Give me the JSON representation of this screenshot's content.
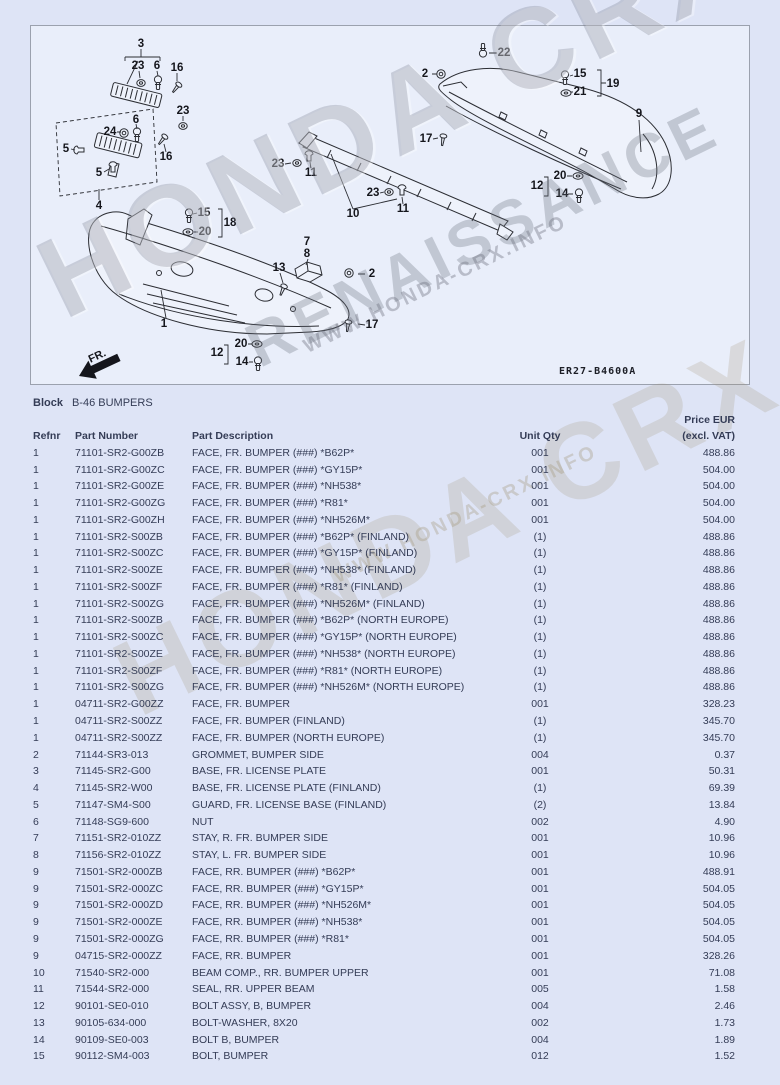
{
  "watermark": {
    "line1": "HONDA CRX",
    "line2": "RENAISSANCE",
    "line3": "WWW.HONDA-CRX.INFO"
  },
  "diagram": {
    "code": "ER27-B4600A",
    "fr_label": "FR.",
    "callouts": [
      {
        "n": "3",
        "x": 110,
        "y": 18
      },
      {
        "n": "23",
        "x": 107,
        "y": 40
      },
      {
        "n": "6",
        "x": 126,
        "y": 40
      },
      {
        "n": "16",
        "x": 146,
        "y": 42
      },
      {
        "n": "23",
        "x": 152,
        "y": 85
      },
      {
        "n": "6",
        "x": 105,
        "y": 94
      },
      {
        "n": "24",
        "x": 79,
        "y": 106
      },
      {
        "n": "16",
        "x": 135,
        "y": 131
      },
      {
        "n": "5",
        "x": 35,
        "y": 123
      },
      {
        "n": "5",
        "x": 68,
        "y": 147
      },
      {
        "n": "4",
        "x": 68,
        "y": 180
      },
      {
        "n": "22",
        "x": 473,
        "y": 27
      },
      {
        "n": "2",
        "x": 394,
        "y": 48
      },
      {
        "n": "15",
        "x": 549,
        "y": 48
      },
      {
        "n": "21",
        "x": 549,
        "y": 66
      },
      {
        "n": "19",
        "x": 582,
        "y": 58
      },
      {
        "n": "9",
        "x": 608,
        "y": 88
      },
      {
        "n": "17",
        "x": 395,
        "y": 113
      },
      {
        "n": "20",
        "x": 529,
        "y": 150
      },
      {
        "n": "12",
        "x": 506,
        "y": 160
      },
      {
        "n": "14",
        "x": 531,
        "y": 168
      },
      {
        "n": "23",
        "x": 247,
        "y": 138
      },
      {
        "n": "11",
        "x": 280,
        "y": 147
      },
      {
        "n": "23",
        "x": 342,
        "y": 167
      },
      {
        "n": "11",
        "x": 372,
        "y": 183
      },
      {
        "n": "10",
        "x": 322,
        "y": 188
      },
      {
        "n": "15",
        "x": 173,
        "y": 187
      },
      {
        "n": "20",
        "x": 174,
        "y": 206
      },
      {
        "n": "18",
        "x": 199,
        "y": 197
      },
      {
        "n": "7",
        "x": 276,
        "y": 216
      },
      {
        "n": "8",
        "x": 276,
        "y": 228
      },
      {
        "n": "13",
        "x": 248,
        "y": 242
      },
      {
        "n": "2",
        "x": 341,
        "y": 248
      },
      {
        "n": "1",
        "x": 133,
        "y": 298
      },
      {
        "n": "17",
        "x": 341,
        "y": 299
      },
      {
        "n": "20",
        "x": 210,
        "y": 318
      },
      {
        "n": "12",
        "x": 186,
        "y": 327
      },
      {
        "n": "14",
        "x": 211,
        "y": 336
      }
    ]
  },
  "block": {
    "label": "Block",
    "value": "B-46 BUMPERS"
  },
  "table": {
    "headers": {
      "refnr": "Refnr",
      "part_number": "Part Number",
      "part_description": "Part Description",
      "unit_qty": "Unit Qty",
      "price_line1": "Price EUR",
      "price_line2": "(excl. VAT)"
    },
    "rows": [
      {
        "refnr": "1",
        "part_number": "71101-SR2-G00ZB",
        "description": "FACE, FR. BUMPER (###) *B62P*",
        "qty": "001",
        "price": "488.86"
      },
      {
        "refnr": "1",
        "part_number": "71101-SR2-G00ZC",
        "description": "FACE, FR. BUMPER (###) *GY15P*",
        "qty": "001",
        "price": "504.00"
      },
      {
        "refnr": "1",
        "part_number": "71101-SR2-G00ZE",
        "description": "FACE, FR. BUMPER (###) *NH538*",
        "qty": "001",
        "price": "504.00"
      },
      {
        "refnr": "1",
        "part_number": "71101-SR2-G00ZG",
        "description": "FACE, FR. BUMPER (###) *R81*",
        "qty": "001",
        "price": "504.00"
      },
      {
        "refnr": "1",
        "part_number": "71101-SR2-G00ZH",
        "description": "FACE, FR. BUMPER (###) *NH526M*",
        "qty": "001",
        "price": "504.00"
      },
      {
        "refnr": "1",
        "part_number": "71101-SR2-S00ZB",
        "description": "FACE, FR. BUMPER (###) *B62P* (FINLAND)",
        "qty": "(1)",
        "price": "488.86"
      },
      {
        "refnr": "1",
        "part_number": "71101-SR2-S00ZC",
        "description": "FACE, FR. BUMPER (###) *GY15P* (FINLAND)",
        "qty": "(1)",
        "price": "488.86"
      },
      {
        "refnr": "1",
        "part_number": "71101-SR2-S00ZE",
        "description": "FACE, FR. BUMPER (###) *NH538* (FINLAND)",
        "qty": "(1)",
        "price": "488.86"
      },
      {
        "refnr": "1",
        "part_number": "71101-SR2-S00ZF",
        "description": "FACE, FR. BUMPER (###) *R81* (FINLAND)",
        "qty": "(1)",
        "price": "488.86"
      },
      {
        "refnr": "1",
        "part_number": "71101-SR2-S00ZG",
        "description": "FACE, FR. BUMPER (###) *NH526M* (FINLAND)",
        "qty": "(1)",
        "price": "488.86"
      },
      {
        "refnr": "1",
        "part_number": "71101-SR2-S00ZB",
        "description": "FACE, FR. BUMPER (###) *B62P* (NORTH EUROPE)",
        "qty": "(1)",
        "price": "488.86"
      },
      {
        "refnr": "1",
        "part_number": "71101-SR2-S00ZC",
        "description": "FACE, FR. BUMPER (###) *GY15P* (NORTH EUROPE)",
        "qty": "(1)",
        "price": "488.86"
      },
      {
        "refnr": "1",
        "part_number": "71101-SR2-S00ZE",
        "description": "FACE, FR. BUMPER (###) *NH538* (NORTH EUROPE)",
        "qty": "(1)",
        "price": "488.86"
      },
      {
        "refnr": "1",
        "part_number": "71101-SR2-S00ZF",
        "description": "FACE, FR. BUMPER (###) *R81* (NORTH EUROPE)",
        "qty": "(1)",
        "price": "488.86"
      },
      {
        "refnr": "1",
        "part_number": "71101-SR2-S00ZG",
        "description": "FACE, FR. BUMPER (###) *NH526M* (NORTH EUROPE)",
        "qty": "(1)",
        "price": "488.86"
      },
      {
        "refnr": "1",
        "part_number": "04711-SR2-G00ZZ",
        "description": "FACE, FR. BUMPER",
        "qty": "001",
        "price": "328.23"
      },
      {
        "refnr": "1",
        "part_number": "04711-SR2-S00ZZ",
        "description": "FACE, FR. BUMPER (FINLAND)",
        "qty": "(1)",
        "price": "345.70"
      },
      {
        "refnr": "1",
        "part_number": "04711-SR2-S00ZZ",
        "description": "FACE, FR. BUMPER (NORTH EUROPE)",
        "qty": "(1)",
        "price": "345.70"
      },
      {
        "refnr": "2",
        "part_number": "71144-SR3-013",
        "description": "GROMMET, BUMPER SIDE",
        "qty": "004",
        "price": "0.37"
      },
      {
        "refnr": "3",
        "part_number": "71145-SR2-G00",
        "description": "BASE, FR. LICENSE PLATE",
        "qty": "001",
        "price": "50.31"
      },
      {
        "refnr": "4",
        "part_number": "71145-SR2-W00",
        "description": "BASE, FR. LICENSE PLATE (FINLAND)",
        "qty": "(1)",
        "price": "69.39"
      },
      {
        "refnr": "5",
        "part_number": "71147-SM4-S00",
        "description": "GUARD, FR. LICENSE BASE (FINLAND)",
        "qty": "(2)",
        "price": "13.84"
      },
      {
        "refnr": "6",
        "part_number": "71148-SG9-600",
        "description": "NUT",
        "qty": "002",
        "price": "4.90"
      },
      {
        "refnr": "7",
        "part_number": "71151-SR2-010ZZ",
        "description": "STAY, R. FR. BUMPER SIDE",
        "qty": "001",
        "price": "10.96"
      },
      {
        "refnr": "8",
        "part_number": "71156-SR2-010ZZ",
        "description": "STAY, L. FR. BUMPER SIDE",
        "qty": "001",
        "price": "10.96"
      },
      {
        "refnr": "9",
        "part_number": "71501-SR2-000ZB",
        "description": "FACE, RR. BUMPER (###) *B62P*",
        "qty": "001",
        "price": "488.91"
      },
      {
        "refnr": "9",
        "part_number": "71501-SR2-000ZC",
        "description": "FACE, RR. BUMPER (###) *GY15P*",
        "qty": "001",
        "price": "504.05"
      },
      {
        "refnr": "9",
        "part_number": "71501-SR2-000ZD",
        "description": "FACE, RR. BUMPER (###) *NH526M*",
        "qty": "001",
        "price": "504.05"
      },
      {
        "refnr": "9",
        "part_number": "71501-SR2-000ZE",
        "description": "FACE, RR. BUMPER (###) *NH538*",
        "qty": "001",
        "price": "504.05"
      },
      {
        "refnr": "9",
        "part_number": "71501-SR2-000ZG",
        "description": "FACE, RR. BUMPER (###) *R81*",
        "qty": "001",
        "price": "504.05"
      },
      {
        "refnr": "9",
        "part_number": "04715-SR2-000ZZ",
        "description": "FACE, RR. BUMPER",
        "qty": "001",
        "price": "328.26"
      },
      {
        "refnr": "10",
        "part_number": "71540-SR2-000",
        "description": "BEAM COMP., RR. BUMPER UPPER",
        "qty": "001",
        "price": "71.08"
      },
      {
        "refnr": "11",
        "part_number": "71544-SR2-000",
        "description": "SEAL, RR. UPPER BEAM",
        "qty": "005",
        "price": "1.58"
      },
      {
        "refnr": "12",
        "part_number": "90101-SE0-010",
        "description": "BOLT ASSY, B, BUMPER",
        "qty": "004",
        "price": "2.46"
      },
      {
        "refnr": "13",
        "part_number": "90105-634-000",
        "description": "BOLT-WASHER, 8X20",
        "qty": "002",
        "price": "1.73"
      },
      {
        "refnr": "14",
        "part_number": "90109-SE0-003",
        "description": "BOLT B, BUMPER",
        "qty": "004",
        "price": "1.89"
      },
      {
        "refnr": "15",
        "part_number": "90112-SM4-003",
        "description": "BOLT, BUMPER",
        "qty": "012",
        "price": "1.52"
      }
    ]
  }
}
